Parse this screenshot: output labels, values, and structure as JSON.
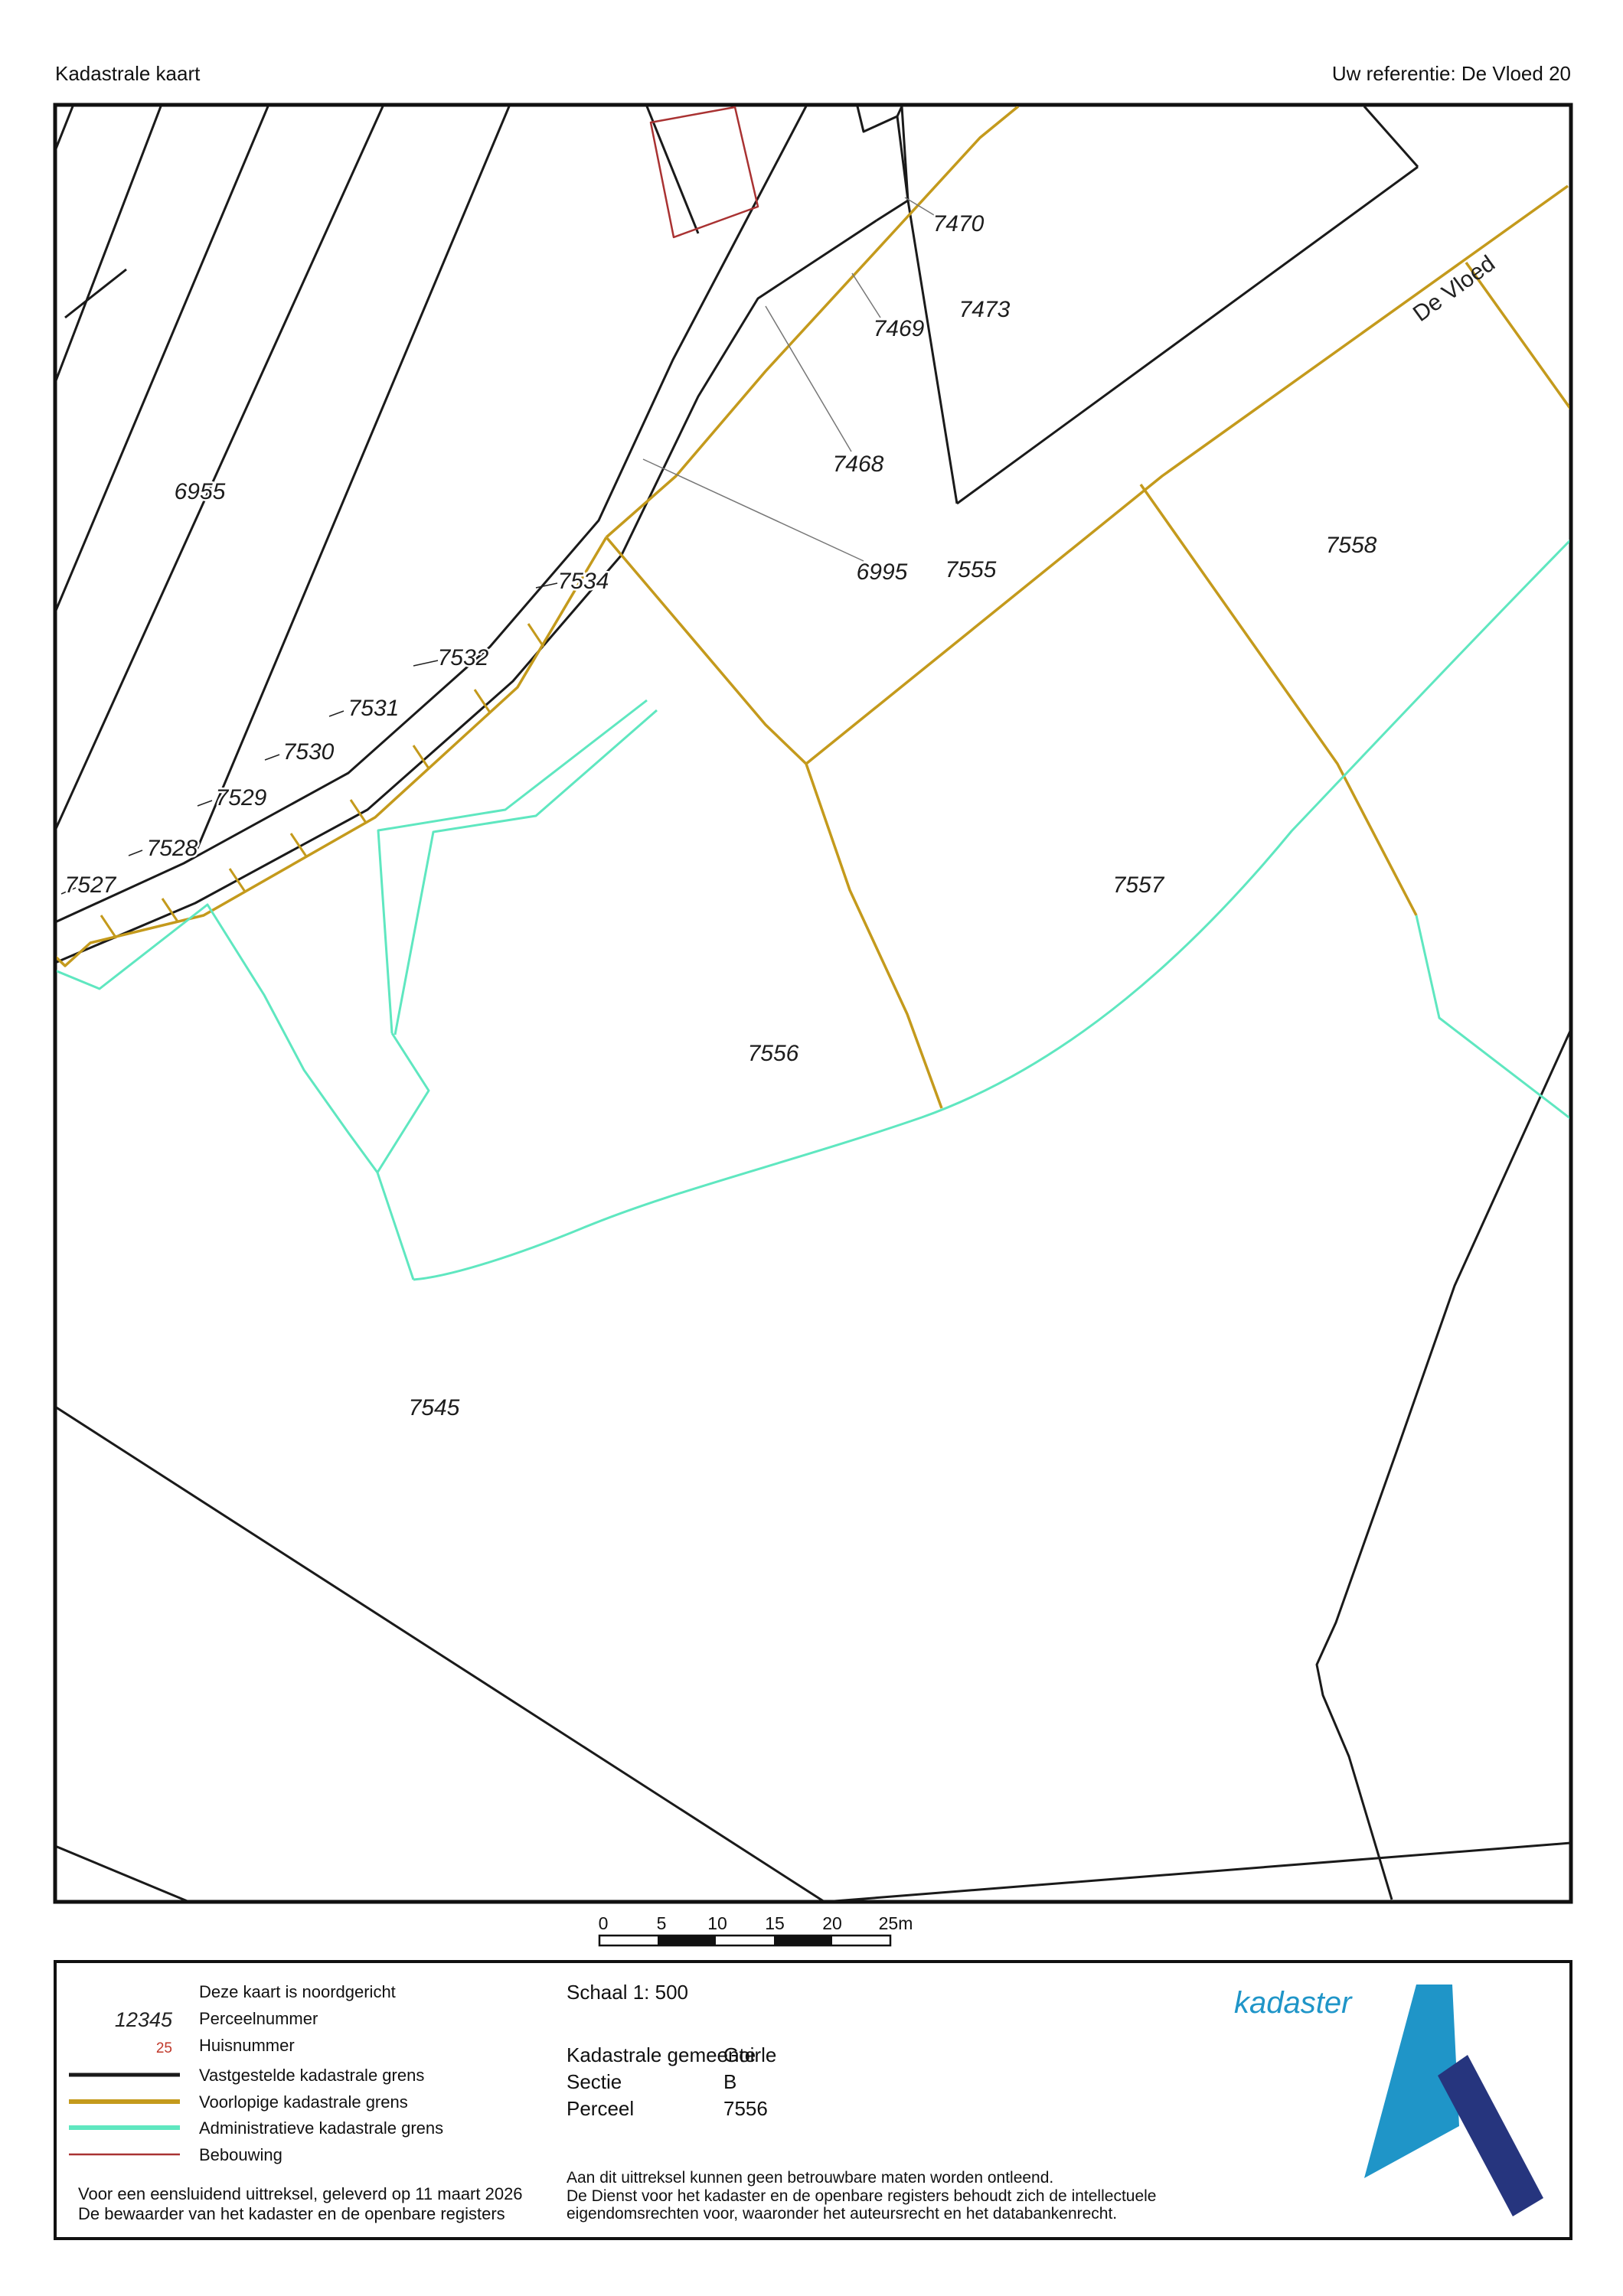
{
  "header": {
    "title": "Kadastrale kaart",
    "reference": "Uw referentie: De Vloed 20"
  },
  "map": {
    "street_name": "De Vloed",
    "parcel_labels": [
      "6955",
      "7527",
      "7528",
      "7529",
      "7530",
      "7531",
      "7532",
      "7534",
      "7468",
      "6995",
      "7555",
      "7470",
      "7473",
      "7469",
      "7558",
      "7557",
      "7556",
      "7545"
    ]
  },
  "scale_bar": {
    "ticks": [
      "0",
      "5",
      "10",
      "15",
      "20",
      "25m"
    ]
  },
  "legend": {
    "north_note": "Deze kaart is noordgericht",
    "items": [
      {
        "sample": "12345",
        "label": "Perceelnummer"
      },
      {
        "sample": "25",
        "label": "Huisnummer"
      },
      {
        "label": "Vastgestelde kadastrale grens"
      },
      {
        "label": "Voorlopige kadastrale grens"
      },
      {
        "label": "Administratieve kadastrale grens"
      },
      {
        "label": "Bebouwing"
      }
    ],
    "footer_line1": "Voor een eensluidend uittreksel, geleverd op 11 maart 2026",
    "footer_line2": "De bewaarder van het kadaster en de openbare registers"
  },
  "info": {
    "scale": "Schaal 1: 500",
    "rows": [
      {
        "label": "Kadastrale gemeente",
        "value": "Goirle"
      },
      {
        "label": "Sectie",
        "value": "B"
      },
      {
        "label": "Perceel",
        "value": "7556"
      }
    ],
    "disclaimer1": "Aan dit uittreksel kunnen geen betrouwbare maten worden ontleend.",
    "disclaimer2": "De Dienst voor het kadaster en de openbare registers behoudt zich de intellectuele",
    "disclaimer3": "eigendomsrechten voor, waaronder het auteursrecht en het databankenrecht."
  },
  "logo": {
    "text": "kadaster"
  },
  "colors": {
    "established_boundary": "#1a1a1a",
    "provisional_boundary": "#C49A1C",
    "administrative_boundary": "#5FE7C0",
    "building": "#A93232",
    "logo_light_blue": "#1F95C8",
    "logo_dark_blue": "#26357E",
    "house_number": "#C0392B"
  }
}
